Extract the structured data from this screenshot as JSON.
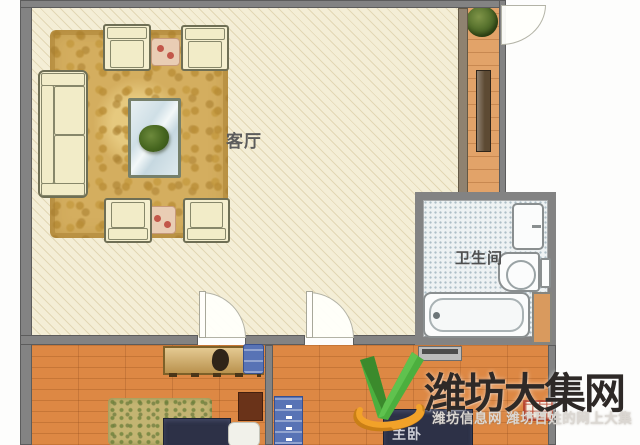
{
  "plan": {
    "type": "apartment-floor-plan",
    "rooms": {
      "living_room": {
        "label": "客厅"
      },
      "bathroom": {
        "label": "卫生间"
      },
      "master_bedroom": {
        "label": "主卧"
      }
    },
    "furniture": {
      "living_room": [
        "sofa",
        "armchair x4",
        "side-table x2",
        "coffee-table-with-plant",
        "area-rug"
      ],
      "entry": [
        "potted-plant",
        "shoe-cabinet",
        "entry-door"
      ],
      "bathroom": [
        "sink",
        "toilet",
        "bathtub",
        "door"
      ],
      "bedroom_left": [
        "desk",
        "chair",
        "bed",
        "pillow",
        "rug",
        "nightstand"
      ],
      "bedroom_right": [
        "dresser",
        "blue-drawer-chest",
        "bed",
        "red-grid-unit"
      ]
    },
    "colors": {
      "living_floor": "#f4eed6",
      "area_rug": "#d4ae5f",
      "corridor_floor": "#e2a369",
      "bedroom_floor": "#dd8844",
      "wall": "#838383",
      "bed": "#2d3147",
      "bath_tile": "#eef2f3",
      "furniture_blue": "#5873b5"
    }
  },
  "watermark": {
    "title": "潍坊大集网",
    "subtitle": "潍坊信息网 潍坊百姓的网上大集",
    "logo": "green-check-with-orange-swoosh",
    "colors": {
      "title": "#2e2927",
      "logo_green": "#4caf3e",
      "logo_orange": "#f2a229"
    }
  }
}
